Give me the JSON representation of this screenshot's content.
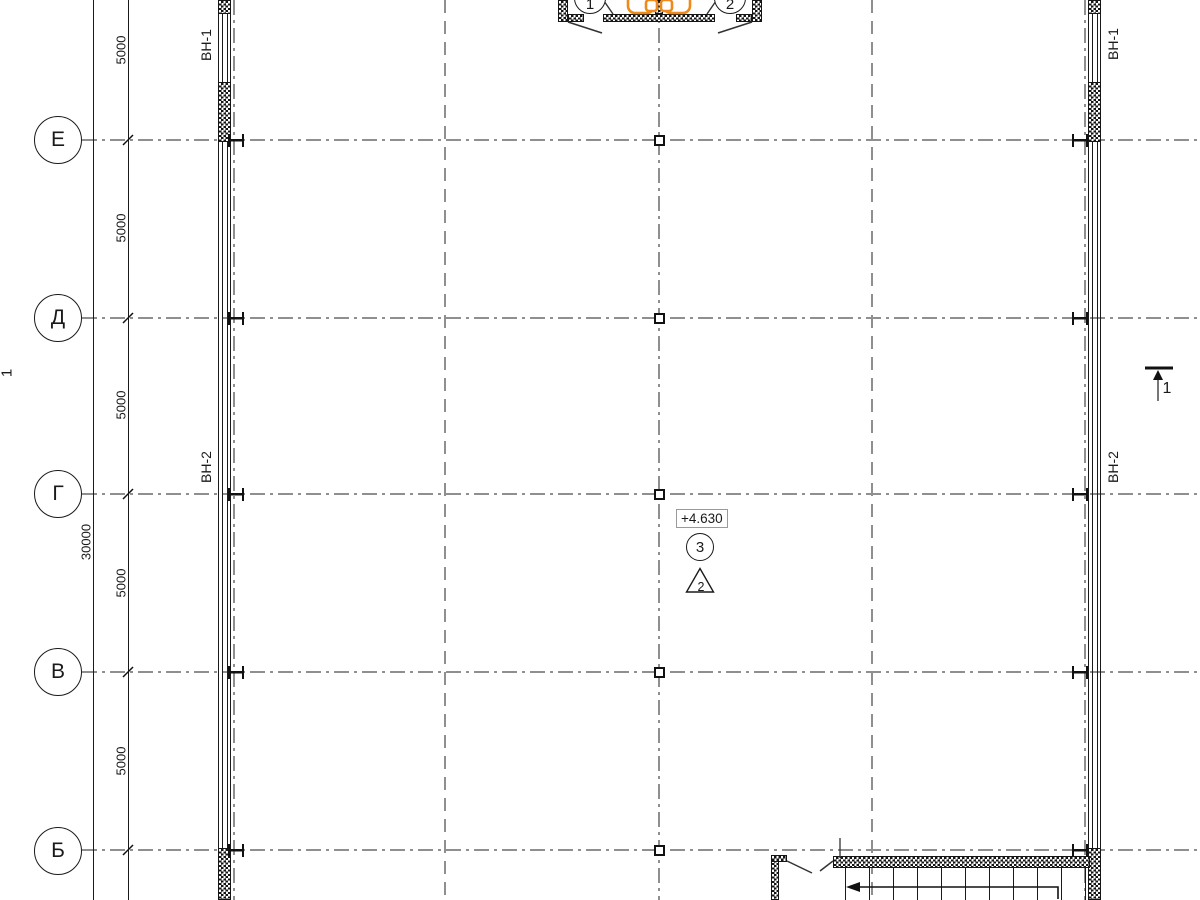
{
  "axes": {
    "rows": [
      {
        "label": "Е"
      },
      {
        "label": "Д"
      },
      {
        "label": "Г"
      },
      {
        "label": "В"
      },
      {
        "label": "Б"
      }
    ]
  },
  "dims": {
    "bays": [
      "5000",
      "5000",
      "5000",
      "5000",
      "5000"
    ],
    "total": "30000"
  },
  "walls": {
    "vn1": "ВН-1",
    "vn2": "ВН-2"
  },
  "bubbles": {
    "left": "1",
    "right": "2"
  },
  "annotations": {
    "elevation": "+4.630",
    "node_number": "3",
    "detail_number": "2"
  },
  "sections": {
    "right": "1",
    "left": "1"
  },
  "colors": {
    "ink": "#1a1a1a",
    "axis_gray": "#8f8f8f",
    "accent_orange": "#ee8a1c"
  }
}
